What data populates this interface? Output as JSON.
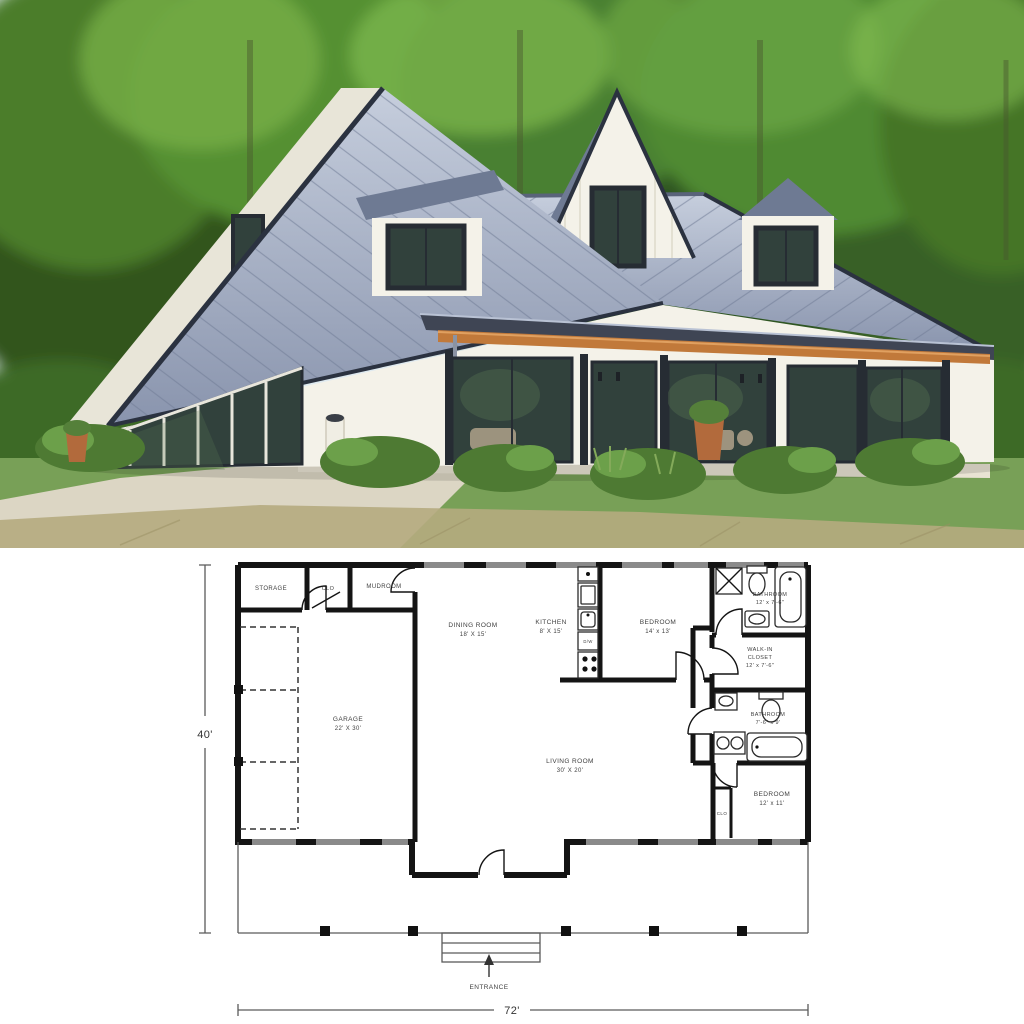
{
  "palette": {
    "sky": "#dfeaf0",
    "foliage_dark": "#2f5520",
    "foliage": "#4b8a2e",
    "foliage_light": "#7ab648",
    "roof": "#9fabc2",
    "roof_light": "#c6cedd",
    "roof_dark": "#6e7a93",
    "fascia": "#2b3240",
    "porch_roof": "#3f4554",
    "wall": "#f4f2e9",
    "wall_shadow": "#e8e5d8",
    "wood": "#c1793a",
    "glass": "#31413c",
    "frame": "#262c33",
    "lawn": "#78a057",
    "dry_grass": "#b5ab80",
    "path": "#dcd6c4",
    "pot": "#b26a3c",
    "plan_wall": "#141414",
    "plan_line": "#5a5a5a",
    "plan_text": "#3f3f3f",
    "plan_window": "#8a8a8a"
  },
  "plan": {
    "dim_height": "40'",
    "dim_width": "72'",
    "entrance": "ENTRANCE",
    "labels": {
      "dishwasher": "D/W"
    },
    "rooms": {
      "storage": {
        "name": "STORAGE"
      },
      "clo1": {
        "name": "CLO"
      },
      "mudroom": {
        "name": "MUDROOM"
      },
      "dining": {
        "name": "DINING ROOM",
        "dims": "18' X 15'"
      },
      "kitchen": {
        "name": "KITCHEN",
        "dims": "8' X 15'"
      },
      "bedroom1": {
        "name": "BEDROOM",
        "dims": "14' x 13'"
      },
      "bathroom1": {
        "name": "BATHROOM",
        "dims": "12' x 7'-6\""
      },
      "walkin": {
        "name_line1": "WALK-IN",
        "name_line2": "CLOSET",
        "dims": "12' x 7'-6\""
      },
      "garage": {
        "name": "GARAGE",
        "dims": "22' X 30'"
      },
      "living": {
        "name": "LIVING ROOM",
        "dims": "30' X 20'"
      },
      "bathroom2": {
        "name": "BATHROOM",
        "dims": "7'-6\" x 9'"
      },
      "bedroom2": {
        "name": "BEDROOM",
        "dims": "12' x 11'"
      },
      "clo2": {
        "name": "CLO"
      }
    }
  }
}
